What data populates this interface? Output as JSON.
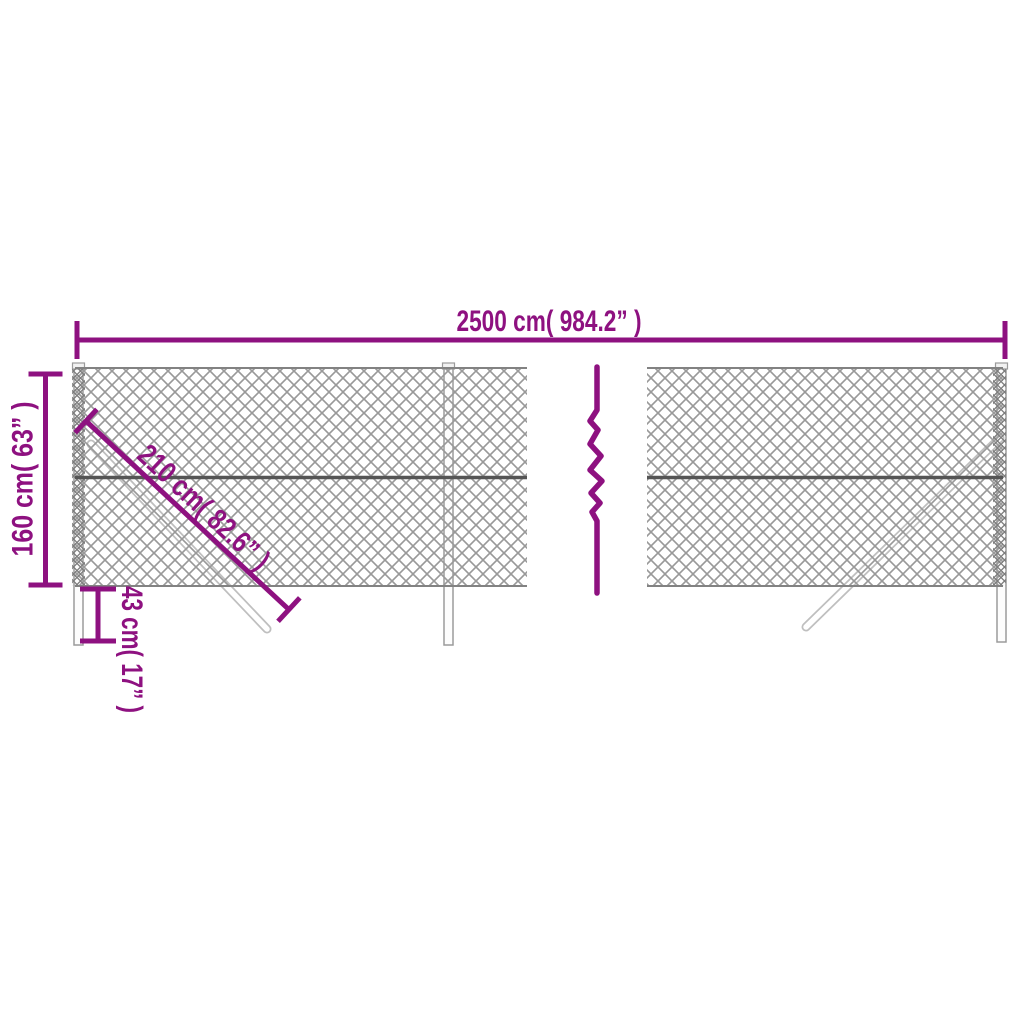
{
  "diagram": {
    "kind": "chain-link-fence-dimension-diagram",
    "break_symbol": "zigzag-continuation"
  },
  "dimensions": {
    "width": {
      "label": "2500 cm( 984.2” )",
      "cm": 2500,
      "inches": 984.2
    },
    "height": {
      "label": "160 cm( 63” )",
      "cm": 160,
      "inches": 63
    },
    "brace": {
      "label": "210 cm( 82.6” )",
      "cm": 210,
      "inches": 82.6
    },
    "post_embed": {
      "label": "43 cm( 17” )",
      "cm": 43,
      "inches": 17
    }
  },
  "colors": {
    "dimension_accent": "#8E1180",
    "mesh_wire": "#999999",
    "mesh_wire_dense": "#7d7d7d",
    "rail": "#555555",
    "post_outline": "#9b9b9b",
    "post_fill": "#fdfdfd",
    "brace_outline": "#bfbfbf",
    "background": "#ffffff"
  }
}
